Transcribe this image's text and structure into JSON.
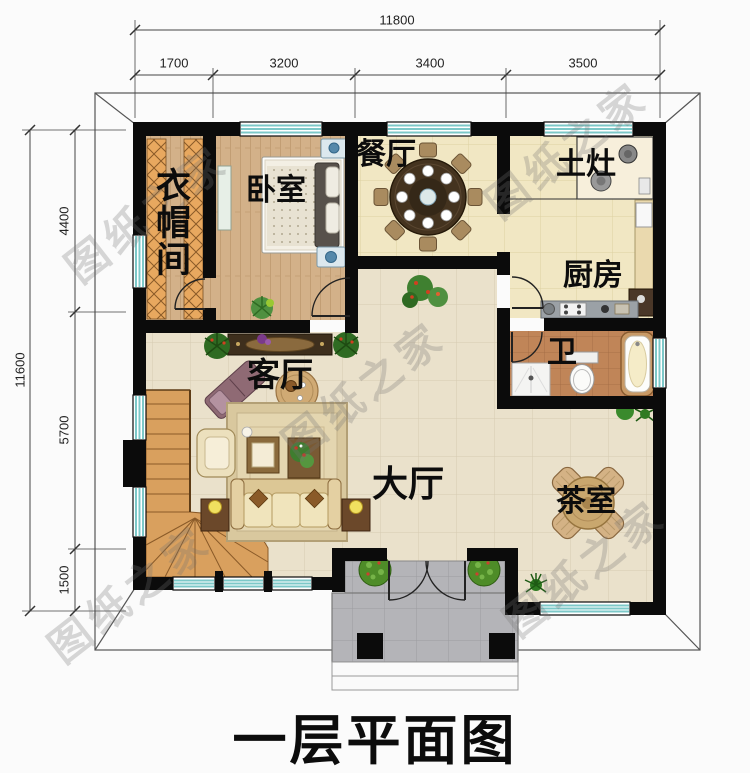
{
  "title": "一层平面图",
  "watermark": {
    "text": "图纸之家"
  },
  "rooms": {
    "cloakroom": "衣帽间",
    "bedroom": "卧室",
    "dining": "餐厅",
    "earthen_stove": "土灶",
    "kitchen": "厨房",
    "bathroom": "卫",
    "living": "客厅",
    "hall": "大厅",
    "tea_room": "茶室"
  },
  "dimensions": {
    "top": {
      "total": "11800",
      "segments": [
        "1700",
        "3200",
        "3400",
        "3500"
      ]
    },
    "left": {
      "total": "11600",
      "segments": [
        "4400",
        "5700",
        "1500"
      ]
    }
  },
  "colors": {
    "wall": "#0b0b0b",
    "window_glass": "#7cc8c8",
    "wood_floor": "#d3b189",
    "tile_warm": "#f1e7c3",
    "tile_neutral": "#eae1cb",
    "bath_tile": "#c08558",
    "porch": "#b4b4b8",
    "stair_wood": "#d9a05e"
  }
}
